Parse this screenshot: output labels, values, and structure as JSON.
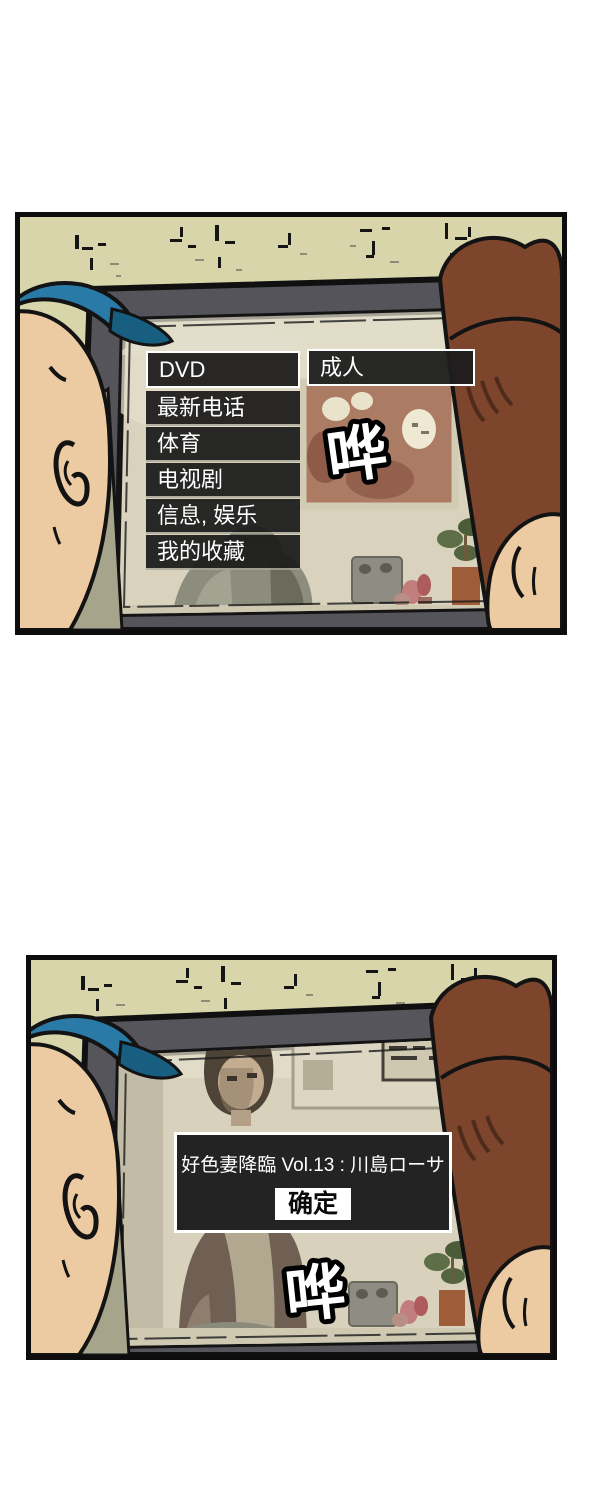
{
  "comic": {
    "panel_count": 2,
    "panel1": {
      "tv_menu": {
        "items": [
          {
            "label": "DVD",
            "selected": true
          },
          {
            "label": "最新电话",
            "selected": false
          },
          {
            "label": "体育",
            "selected": false
          },
          {
            "label": "电视剧",
            "selected": false
          },
          {
            "label": "信息, 娱乐",
            "selected": false
          },
          {
            "label": "我的收藏",
            "selected": false
          }
        ],
        "submenu": {
          "label": "成人",
          "selected": true
        }
      },
      "sfx": "哗"
    },
    "panel2": {
      "dialog": {
        "title": "好色妻降臨 Vol.13 : 川島ローサ",
        "confirm_label": "确定"
      },
      "sfx": "哗"
    }
  },
  "colors": {
    "page_background": "#ffffff",
    "panel_border": "#0d0d0d",
    "wall": "#d8d5aa",
    "tv_frame": "#55545a",
    "tv_screen": "#d9d3bd",
    "menu_background": "#1e1e1e",
    "menu_text": "#ffffff",
    "selection_border": "#ffffff",
    "dialog_background": "#232323",
    "confirm_button_background": "#ffffff",
    "confirm_button_text": "#0a0a0a",
    "cap_blue": "#2a7aa8",
    "cap_brim": "#185e80",
    "skin": "#eccaa2",
    "hair_brown": "#7c452c",
    "painting": "#ab7b64",
    "plant_green": "#5e6e46",
    "plant_pot": "#9e5c38",
    "sfx_fill": "#ffffff",
    "sfx_outline": "#000000"
  }
}
